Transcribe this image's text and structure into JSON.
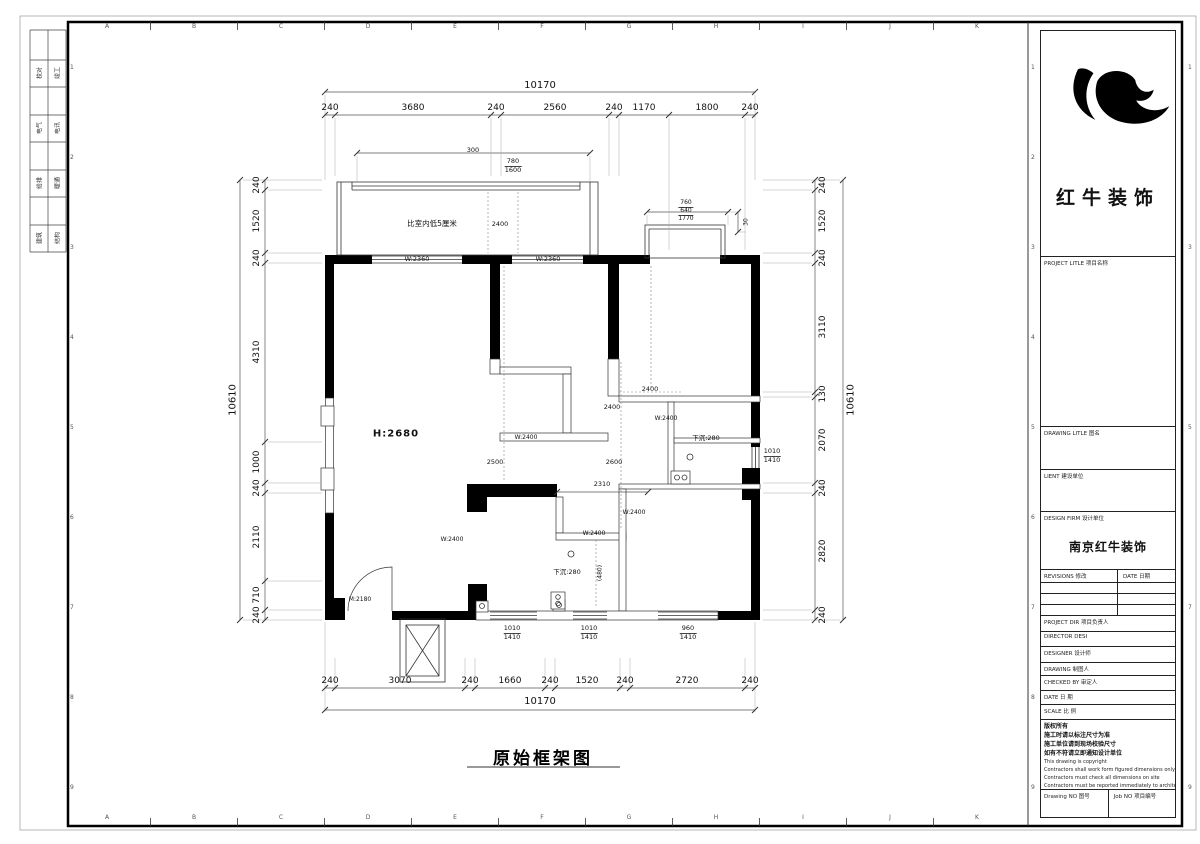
{
  "border": {
    "grid_letters": [
      "A",
      "B",
      "C",
      "D",
      "E",
      "F",
      "G",
      "H",
      "I",
      "J",
      "K"
    ],
    "grid_numbers": [
      "1",
      "2",
      "3",
      "4",
      "5",
      "6",
      "7",
      "8",
      "9"
    ],
    "signoff_rows": [
      {
        "left": "校对",
        "right": "竣工"
      },
      {
        "left": "电气",
        "right": "电讯"
      },
      {
        "left": "给排",
        "right": "暖通"
      },
      {
        "left": "建筑",
        "right": "结构"
      }
    ]
  },
  "title_block": {
    "brand": "红牛装饰",
    "project_title_label": "PROJECT LITLE  项目名称",
    "drawing_title_label": "DRAWING LITLE  图名",
    "client_label": "LIENT  建设单位",
    "design_firm_label": "DESIGN FIRM  设计单位",
    "design_firm_value": "南京红牛装饰",
    "revisions_label": "REVISIONS  修改",
    "date_col_label": "DATE  日期",
    "project_dir_label": "PROJECT DIR    项目负责人",
    "director_label": "DIRECTOR DESI",
    "designer_label": "DESIGNER       设计师",
    "drawing_label": "DRAWING        制图人",
    "checked_label": "CHECKED BY     审定人",
    "date_label": "DATE           日  期",
    "scale_label": "SCALE          比  例",
    "notes": [
      "版权所有",
      "施工时请以标注尺寸为准",
      "施工单位请到现场校验尺寸",
      "如有不符请立即通知设计单位",
      "This drawing is copyright",
      "Contractors shall work form figured dimensions only",
      "Contractors must check all dimensions on site",
      "Contractors must be reported immediately to architects"
    ],
    "drawing_no_label": "Drawing NO  图号",
    "job_no_label": "Job NO  项目编号"
  },
  "plan": {
    "title": "原始框架图",
    "dims": {
      "top_total": "10170",
      "top": [
        "240",
        "3680",
        "240",
        "2560",
        "240",
        "1170",
        "1800",
        "240"
      ],
      "bottom": [
        "240",
        "3070",
        "240",
        "1660",
        "240",
        "1520",
        "240",
        "2720",
        "240"
      ],
      "bottom_total": "10170",
      "left_total": "10610",
      "left": [
        "240",
        "1520",
        "240",
        "4310",
        "1000",
        "240",
        "2110",
        "710",
        "240"
      ],
      "right": [
        "240",
        "1520",
        "240",
        "3110",
        "130",
        "2070",
        "240",
        "2820",
        "240"
      ],
      "right_total": "10610",
      "balcony_width": "300",
      "balcony_window_top": "780",
      "balcony_window_bot": "1600",
      "bay_1": "760",
      "bay_2": "640",
      "bay_3": "1770",
      "bay_side": "30"
    },
    "labels": {
      "balcony_note": "比室内低5厘米",
      "balcony_depth": "2400",
      "win_a": "W:2360",
      "win_b": "W:2360",
      "height": "H:2680",
      "d2400a": "2400",
      "d2400b": "2400",
      "door_a": "W:2400",
      "door_b": "W:2400",
      "door_c": "W:2400",
      "door_d": "W:2400",
      "door_e": "W:2400",
      "d2500": "2500",
      "d2600": "2600",
      "sunken_a": "下沉:280",
      "sunken_b": "下沉:280",
      "d2310": "2310",
      "d480": "(480)",
      "entry_door": "M:2180",
      "win_right_t": "1010",
      "win_right_b": "1410",
      "win_b1_t": "1010",
      "win_b1_b": "1410",
      "win_b2_t": "1010",
      "win_b2_b": "1410",
      "win_b3_t": "960",
      "win_b3_b": "1410"
    }
  }
}
